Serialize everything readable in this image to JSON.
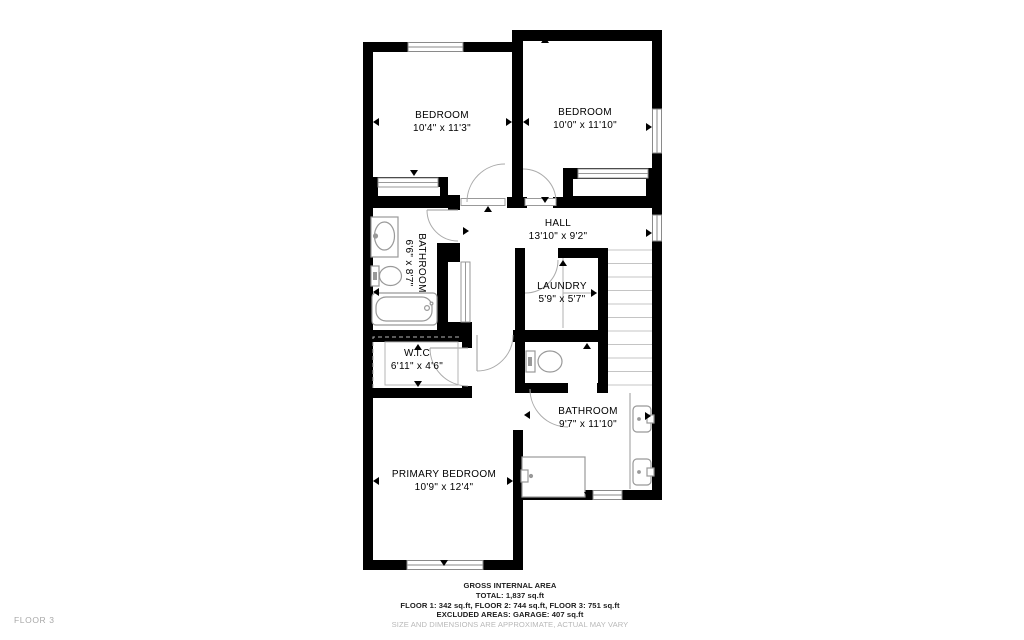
{
  "floor_label": "FLOOR 3",
  "rooms": {
    "bedroom1": {
      "name": "BEDROOM",
      "dims": "10'4\" x 11'3\""
    },
    "bedroom2": {
      "name": "BEDROOM",
      "dims": "10'0\" x 11'10\""
    },
    "hall": {
      "name": "HALL",
      "dims": "13'10\" x 9'2\""
    },
    "bathroom1": {
      "name": "BATHROOM",
      "dims": "6'6\" x 8'7\""
    },
    "laundry": {
      "name": "LAUNDRY",
      "dims": "5'9\" x 5'7\""
    },
    "wic": {
      "name": "W.I.C",
      "dims": "6'11\" x 4'6\""
    },
    "primary": {
      "name": "PRIMARY BEDROOM",
      "dims": "10'9\" x 12'4\""
    },
    "bathroom2": {
      "name": "BATHROOM",
      "dims": "9'7\" x 11'10\""
    }
  },
  "footer": {
    "line1": "GROSS INTERNAL AREA",
    "line2": "TOTAL: 1,837 sq.ft",
    "line3": "FLOOR 1: 342 sq.ft, FLOOR 2: 744 sq.ft, FLOOR 3: 751 sq.ft",
    "line4": "EXCLUDED AREAS: GARAGE: 407 sq.ft",
    "disclaimer": "SIZE AND DIMENSIONS ARE APPROXIMATE, ACTUAL MAY VARY"
  },
  "colors": {
    "wall": "#000000",
    "fixture": "#999999",
    "stair_tread": "#c4c4c4",
    "disclaimer_text": "#b8b8b8",
    "floor_tag_text": "#a8a8a8"
  }
}
